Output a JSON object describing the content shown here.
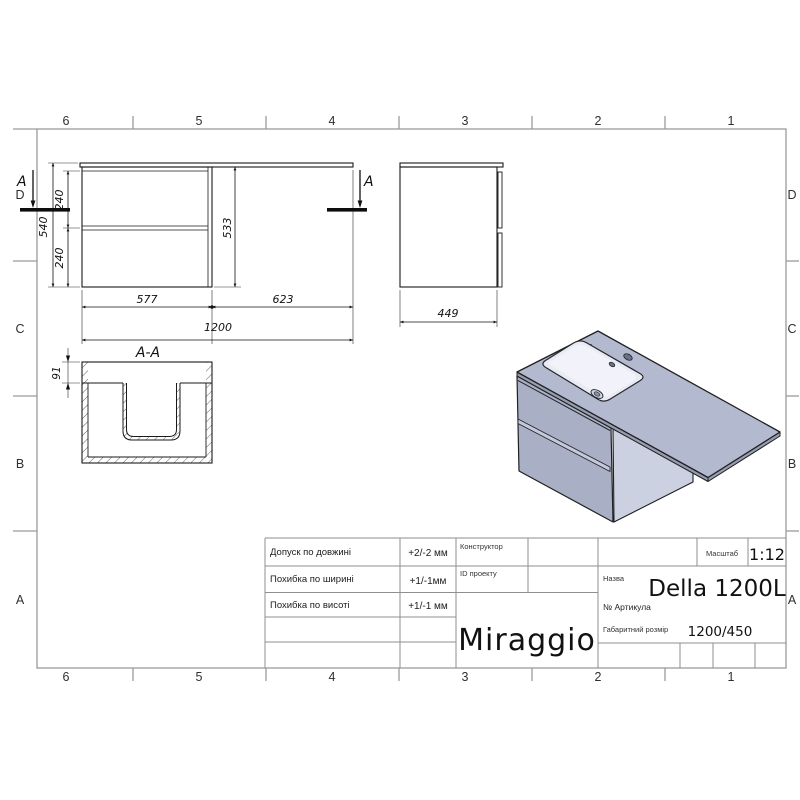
{
  "zones": {
    "columns": [
      "6",
      "5",
      "4",
      "3",
      "2",
      "1"
    ],
    "rows": [
      "D",
      "C",
      "B",
      "A"
    ]
  },
  "front_view": {
    "section_letter": "A",
    "dim_total_height": "540",
    "dim_drawer_top": "240",
    "dim_drawer_bottom": "240",
    "dim_cabinet_height": "533",
    "dim_cabinet_width": "577",
    "dim_counter_extension": "623",
    "dim_total_width": "1200"
  },
  "side_view": {
    "dim_depth": "449"
  },
  "section_view": {
    "title": "A-A",
    "dim_counter_thickness": "91"
  },
  "title_block": {
    "tolerances": [
      {
        "label": "Допуск по довжині",
        "value": "+2/-2 мм"
      },
      {
        "label": "Похибка по ширині",
        "value": "+1/-1мм"
      },
      {
        "label": "Похибка по висоті",
        "value": "+1/-1 мм"
      }
    ],
    "constructor_label": "Конструктор",
    "project_id_label": "ID проекту",
    "brand": "Miraggio",
    "scale_label": "Масштаб",
    "scale_value": "1:12",
    "name_label": "Назва",
    "name_value": "Della 1200L",
    "article_label": "№  Артикула",
    "size_label": "Габаритний розмір",
    "size_value": "1200/450"
  },
  "colors": {
    "line": "#1e1e1e",
    "frame": "#9a9a9a",
    "table": "#8f8f8f",
    "iso_top": "#b3bacf",
    "iso_front": "#a9b0c6",
    "iso_side": "#ccd1e2",
    "iso_edge": "#969cb1",
    "iso_gap": "#c3c9da",
    "bowl": "#e8ebf3",
    "bowl_hi": "#f3f5fa",
    "hole": "#6a7288"
  }
}
